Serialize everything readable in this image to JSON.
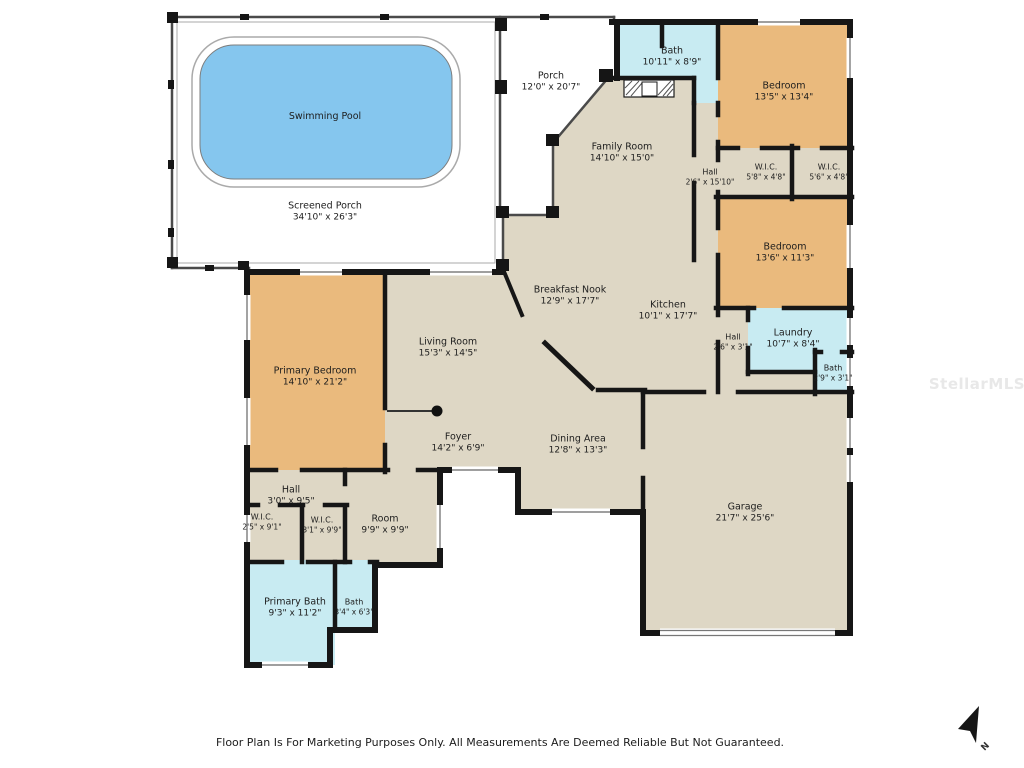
{
  "colors": {
    "floor": "#ded7c5",
    "bedroom": "#eaba7d",
    "wet": "#c8ebf2",
    "pool": "#85c6ee",
    "wall": "#161616",
    "line": "#4a4a4a"
  },
  "footer": {
    "disclaimer": "Floor Plan Is For Marketing Purposes Only. All Measurements Are Deemed Reliable But Not Guaranteed."
  },
  "compass": {
    "label": "N"
  },
  "watermark": {
    "text": "StellarMLS"
  },
  "rooms": {
    "swimming_pool": {
      "name": "Swimming Pool",
      "dims": ""
    },
    "screened_porch": {
      "name": "Screened Porch",
      "dims": "34'10\" x 26'3\""
    },
    "porch": {
      "name": "Porch",
      "dims": "12'0\" x 20'7\""
    },
    "bath_top": {
      "name": "Bath",
      "dims": "10'11\" x 8'9\""
    },
    "bedroom_top_right": {
      "name": "Bedroom",
      "dims": "13'5\" x 13'4\""
    },
    "wic_top_left": {
      "name": "W.I.C.",
      "dims": "5'8\" x 4'8\""
    },
    "wic_top_right": {
      "name": "W.I.C.",
      "dims": "5'6\" x 4'8\""
    },
    "family_room": {
      "name": "Family Room",
      "dims": "14'10\" x 15'0\""
    },
    "hall_tall": {
      "name": "Hall",
      "dims": "2'6\" x 15'10\""
    },
    "bedroom_right": {
      "name": "Bedroom",
      "dims": "13'6\" x 11'3\""
    },
    "breakfast_nook": {
      "name": "Breakfast Nook",
      "dims": "12'9\" x 17'7\""
    },
    "kitchen": {
      "name": "Kitchen",
      "dims": "10'1\" x 17'7\""
    },
    "hall_kitchen": {
      "name": "Hall",
      "dims": "2'6\" x 3'1\""
    },
    "laundry": {
      "name": "Laundry",
      "dims": "10'7\" x 8'4\""
    },
    "bath_laundry": {
      "name": "Bath",
      "dims": "2'9\" x 3'1\""
    },
    "living_room": {
      "name": "Living Room",
      "dims": "15'3\" x 14'5\""
    },
    "primary_bedroom": {
      "name": "Primary Bedroom",
      "dims": "14'10\" x 21'2\""
    },
    "foyer": {
      "name": "Foyer",
      "dims": "14'2\" x 6'9\""
    },
    "dining_area": {
      "name": "Dining Area",
      "dims": "12'8\" x 13'3\""
    },
    "garage": {
      "name": "Garage",
      "dims": "21'7\" x 25'6\""
    },
    "hall_bottom": {
      "name": "Hall",
      "dims": "3'0\" x 9'5\""
    },
    "wic_bottom_left": {
      "name": "W.I.C.",
      "dims": "2'5\" x 9'1\""
    },
    "wic_bottom_right": {
      "name": "W.I.C.",
      "dims": "3'1\" x 9'9\""
    },
    "room": {
      "name": "Room",
      "dims": "9'9\" x 9'9\""
    },
    "primary_bath": {
      "name": "Primary Bath",
      "dims": "9'3\" x 11'2\""
    },
    "bath_bottom": {
      "name": "Bath",
      "dims": "3'4\" x 6'3\""
    }
  }
}
